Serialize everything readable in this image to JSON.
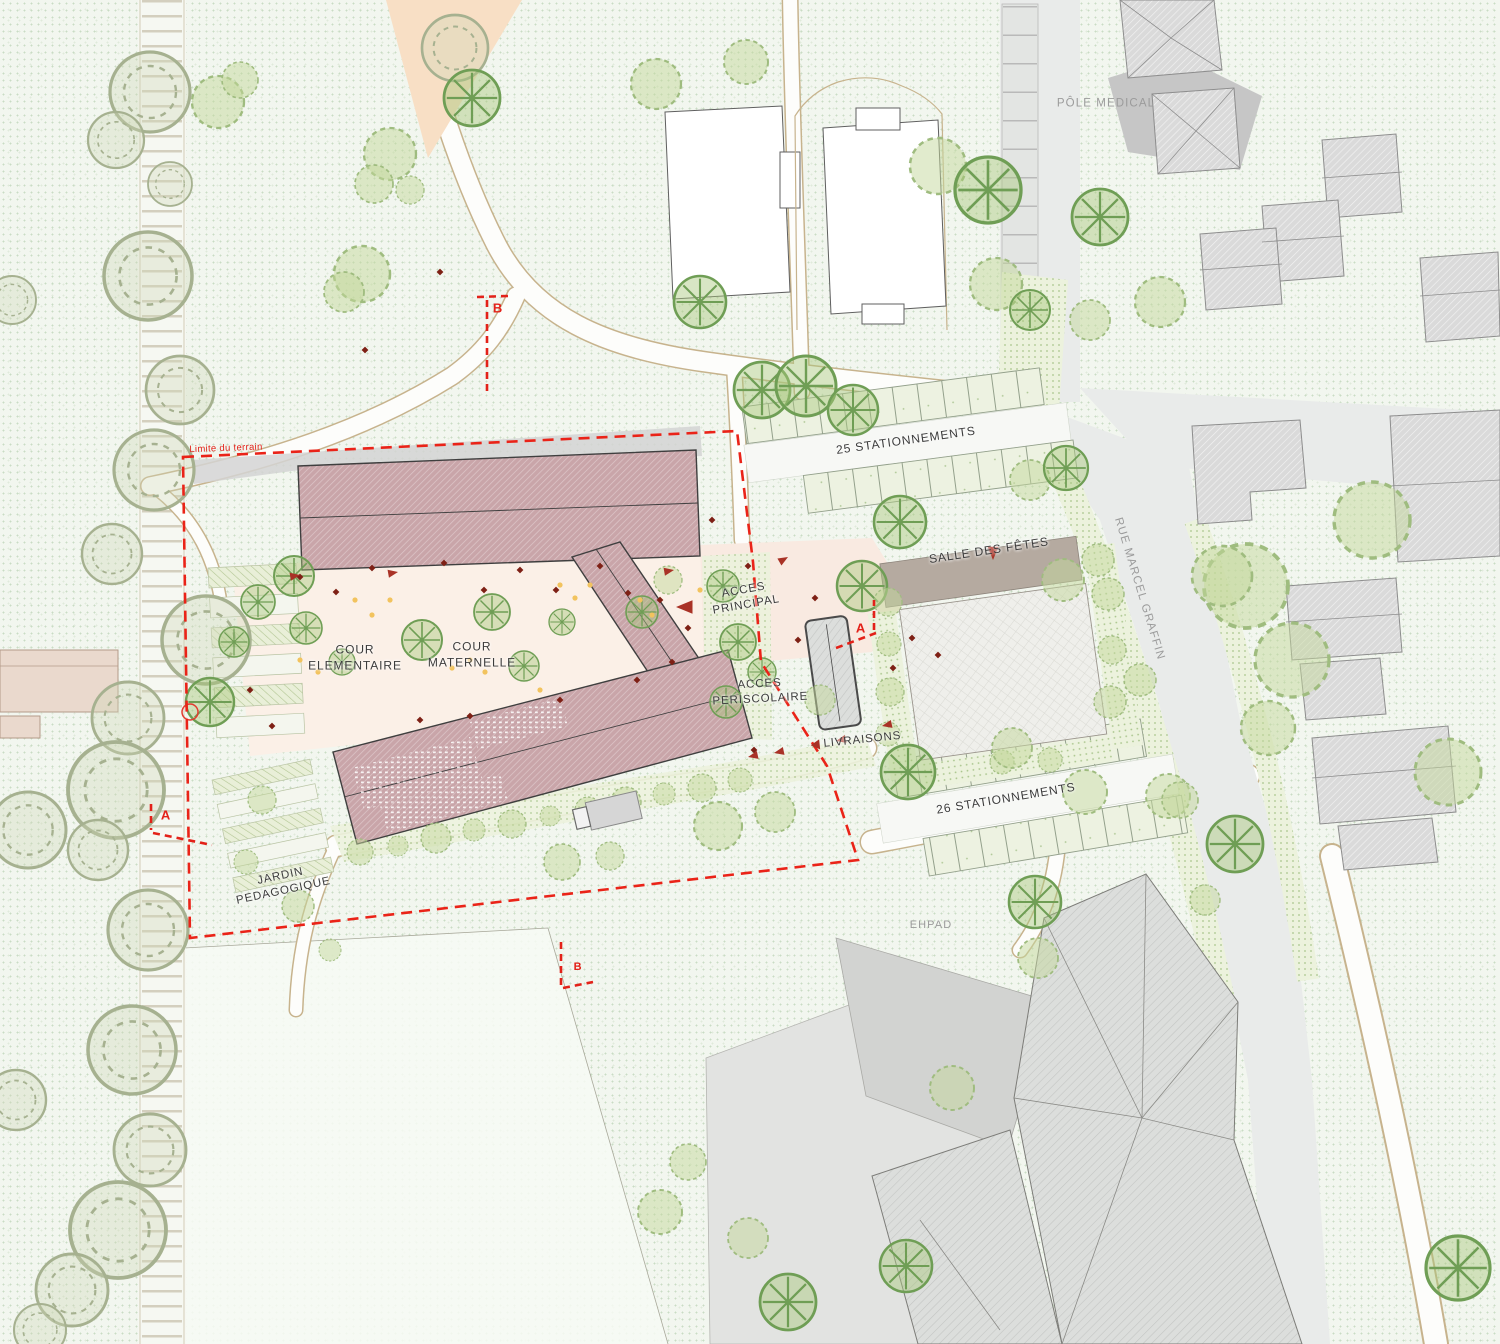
{
  "labels": {
    "pole_medical": "PÔLE MEDICAL",
    "parking_north": "25 STATIONNEMENTS",
    "salle_des_fetes": "SALLE DES FÊTES",
    "rue_marcel_graffin": "RUE MARCEL GRAFFIN",
    "acces_principal": [
      "ACCES",
      "PRINCIPAL"
    ],
    "cour_elementaire": [
      "COUR",
      "ELEMENTAIRE"
    ],
    "cour_maternelle": [
      "COUR",
      "MATERNELLE"
    ],
    "acces_periscolaire": [
      "ACCES",
      "PERISCOLAIRE"
    ],
    "livraisons": "LIVRAISONS",
    "parking_south": "26 STATIONNEMENTS",
    "jardin_pedagogique": [
      "JARDIN",
      "PEDAGOGIQUE"
    ],
    "ehpad": "EHPAD",
    "limite_terrain": "Limite du terrain",
    "section_marker_a": "A",
    "section_marker_b": "B"
  },
  "colors": {
    "site_boundary_red": "#e32119",
    "school_roof_pink": "#c9a5a9",
    "plaza_peach": "#f9eae1",
    "playground_peach": "#f8dfc5",
    "lawn_dot_green": "#c9dcc4",
    "road_grey": "#e9ebea",
    "building_grey": "#dadada",
    "salle_band_taupe": "#b5aaa0",
    "label_dark": "#3c3c3c",
    "label_grey": "#9b9b9b",
    "marker_dark_red": "#7e2015",
    "arrow_red": "#a93226"
  }
}
